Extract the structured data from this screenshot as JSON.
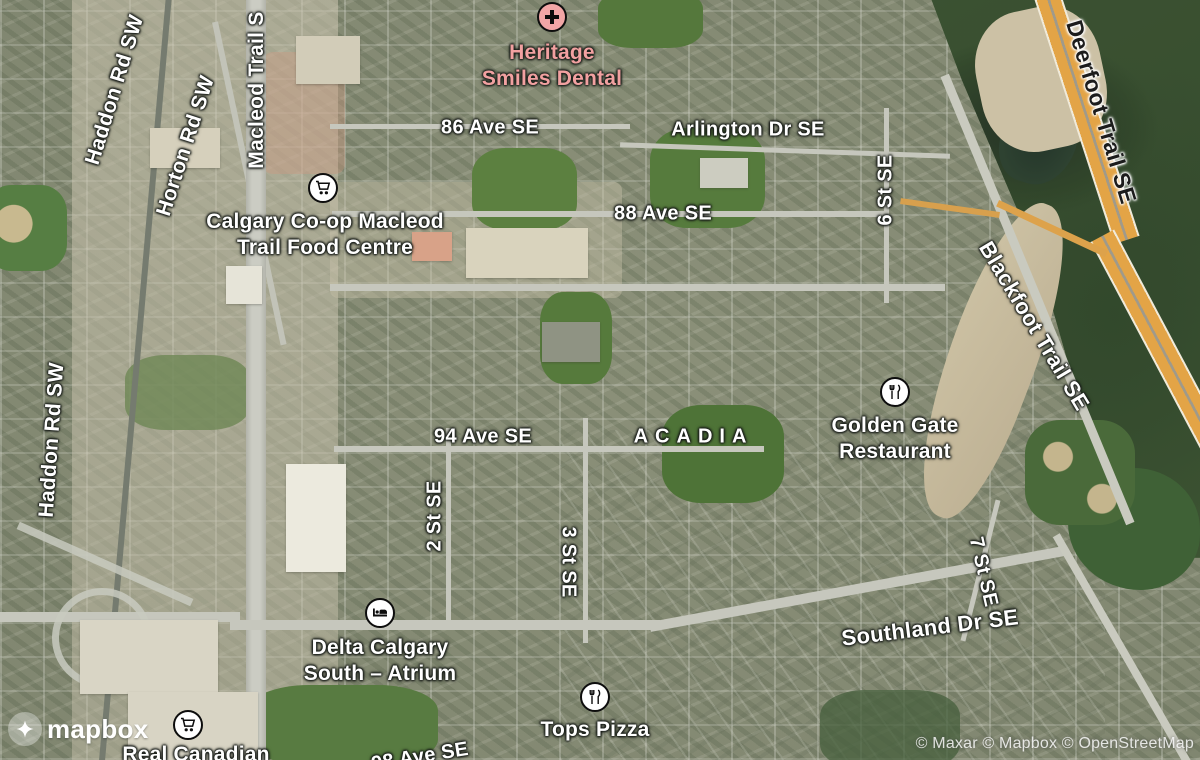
{
  "roads": {
    "macleod": "Macleod Trail S",
    "horton": "Horton Rd SW",
    "haddon": "Haddon Rd SW",
    "ave86": "86 Ave SE",
    "arlington": "Arlington Dr SE",
    "ave88": "88 Ave SE",
    "st6": "6 St SE",
    "deerfoot": "Deerfoot Trail SE",
    "blackfoot": "Blackfoot Trail SE",
    "ave94": "94 Ave SE",
    "st2": "2 St SE",
    "st3": "3 St SE",
    "st7": "7 St SE",
    "southland": "Southland Dr SE",
    "ave98": "98 Ave SE"
  },
  "neighborhood": "ACADIA",
  "pois": {
    "heritage": {
      "line1": "Heritage",
      "line2": "Smiles Dental",
      "icon": "hospital-cross-icon",
      "label_color": "#f2a1a1"
    },
    "coop": {
      "line1": "Calgary Co-op Macleod",
      "line2": "Trail Food Centre",
      "icon": "shopping-cart-icon"
    },
    "golden_gate": {
      "line1": "Golden Gate",
      "line2": "Restaurant",
      "icon": "restaurant-icon"
    },
    "delta": {
      "line1": "Delta Calgary",
      "line2": "South – Atrium",
      "icon": "lodging-icon"
    },
    "tops": {
      "line1": "Tops Pizza",
      "icon": "restaurant-icon"
    },
    "superstore": {
      "line1": "Real Canadian",
      "icon": "shopping-cart-icon"
    }
  },
  "branding": {
    "logo": "mapbox",
    "logo_icon": "mapbox-logo-icon"
  },
  "attribution": "© Maxar © Mapbox © OpenStreetMap",
  "colors": {
    "highway_orange": "#e3a446",
    "poi_pink": "#f2a1a1",
    "road_label_white": "#ffffff",
    "highway_label_black": "#1c1c1c",
    "valley_green": "#3a5a36",
    "sand_tan": "#cdc2a4"
  }
}
